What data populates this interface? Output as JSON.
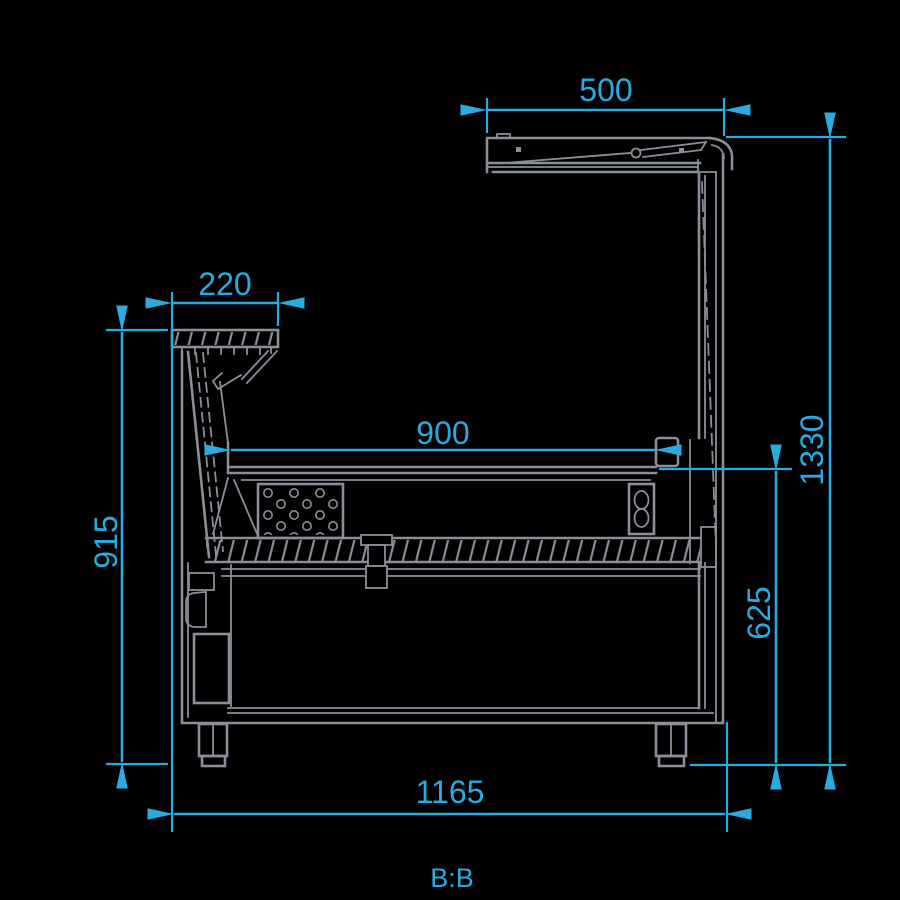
{
  "page": {
    "background": "#000000"
  },
  "drawing": {
    "type": "technical-cross-section",
    "subject": "serve-over refrigerated display counter, sectional view",
    "section_label": "B:B",
    "line_color": "#8a8e98",
    "dimension_color": "#29abe2",
    "dimensions": [
      {
        "name": "canopy-depth",
        "value": "500",
        "orientation": "horizontal",
        "position": "top"
      },
      {
        "name": "front-shelf-depth",
        "value": "220",
        "orientation": "horizontal",
        "position": "upper-left"
      },
      {
        "name": "display-deck-depth",
        "value": "900",
        "orientation": "horizontal",
        "position": "middle"
      },
      {
        "name": "front-height",
        "value": "915",
        "orientation": "vertical",
        "position": "left"
      },
      {
        "name": "overall-height",
        "value": "1330",
        "orientation": "vertical",
        "position": "far-right"
      },
      {
        "name": "deck-height",
        "value": "625",
        "orientation": "vertical",
        "position": "right"
      },
      {
        "name": "overall-depth",
        "value": "1165",
        "orientation": "horizontal",
        "position": "bottom"
      }
    ]
  }
}
